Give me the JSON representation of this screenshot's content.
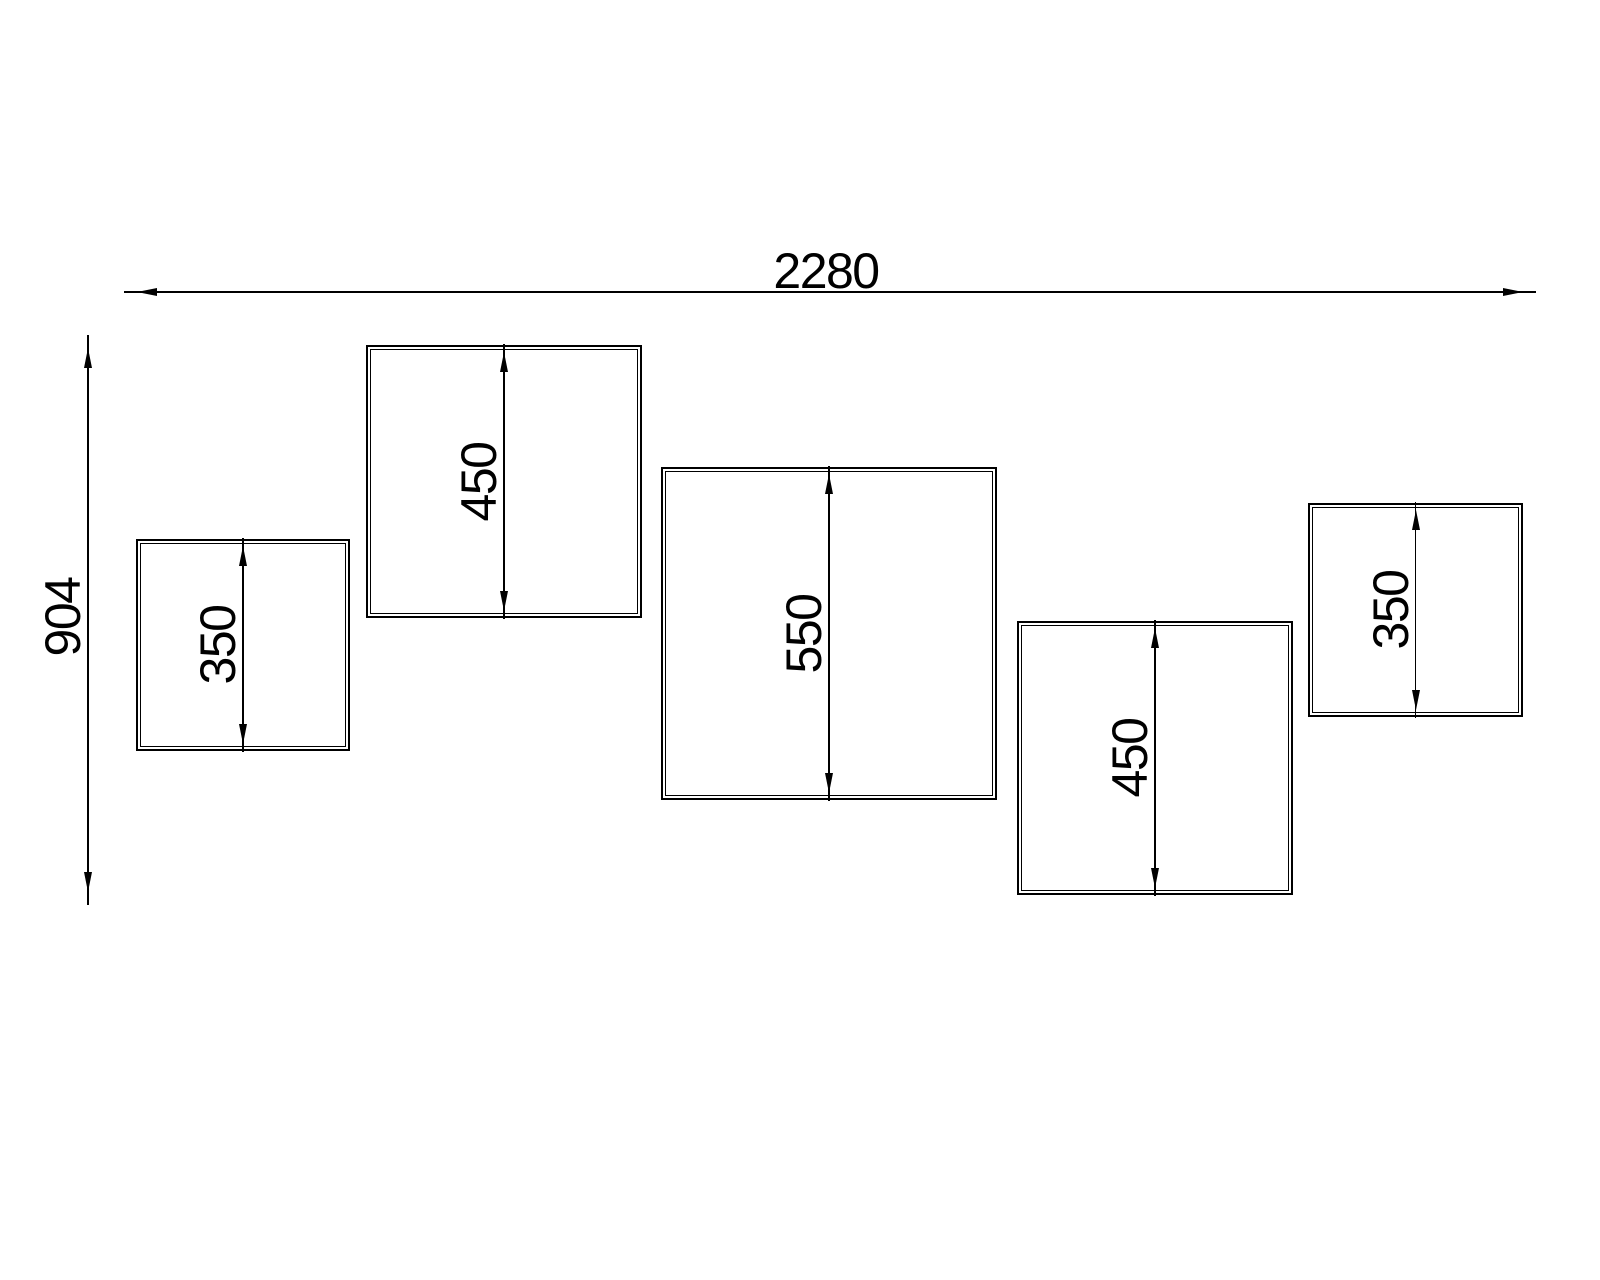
{
  "drawing": {
    "description": "Staggered wall panel elevation with dimensions",
    "background_color": "#ffffff",
    "line_color": "#000000",
    "overall_width": {
      "value": 2280,
      "label": "2280"
    },
    "overall_height": {
      "value": 904,
      "label": "904"
    },
    "panels": [
      {
        "id": "panel-1",
        "size_value": 350,
        "size_label": "350"
      },
      {
        "id": "panel-2",
        "size_value": 450,
        "size_label": "450"
      },
      {
        "id": "panel-3",
        "size_value": 550,
        "size_label": "550"
      },
      {
        "id": "panel-4",
        "size_value": 450,
        "size_label": "450"
      },
      {
        "id": "panel-5",
        "size_value": 350,
        "size_label": "350"
      }
    ]
  }
}
